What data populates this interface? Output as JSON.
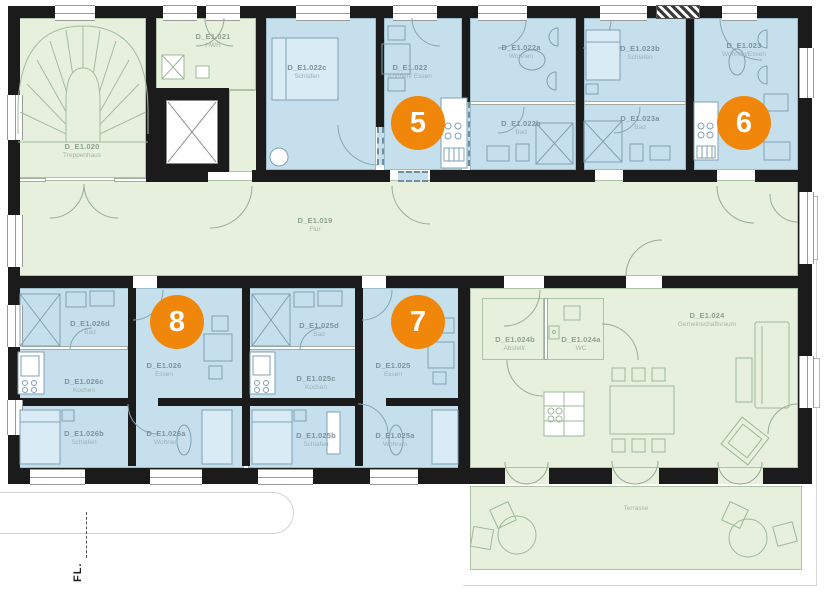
{
  "palette": {
    "room_blue": "#c5e0ec",
    "room_green": "#e6f0dc",
    "wall_black": "#1b1b1b",
    "badge_orange": "#f0870b"
  },
  "rooms": {
    "r019": {
      "id": "D_E1.019",
      "name": "Flur"
    },
    "r020": {
      "id": "D_E1.020",
      "name": "Treppenhaus"
    },
    "r021": {
      "id": "D_E1.021",
      "name": "HWR"
    },
    "r022": {
      "id": "D_E1.022",
      "name": "Kochen/ Essen"
    },
    "r022a": {
      "id": "D_E1.022a",
      "name": "Wohnen"
    },
    "r022b": {
      "id": "D_E1.022b",
      "name": "Bad"
    },
    "r022c": {
      "id": "D_E1.022c",
      "name": "Schlafen"
    },
    "r023": {
      "id": "D_E1.023",
      "name": "Wohnen/Essen"
    },
    "r023a": {
      "id": "D_E1.023a",
      "name": "Bad"
    },
    "r023b": {
      "id": "D_E1.023b",
      "name": "Schlafen"
    },
    "r024": {
      "id": "D_E1.024",
      "name": "Gemeinschaftsraum"
    },
    "r024a": {
      "id": "D_E1.024a",
      "name": "WC"
    },
    "r024b": {
      "id": "D_E1.024b",
      "name": "Abstellr."
    },
    "r025": {
      "id": "D_E1.025",
      "name": "Essen"
    },
    "r025a": {
      "id": "D_E1.025a",
      "name": "Wohnen"
    },
    "r025b": {
      "id": "D_E1.025b",
      "name": "Schlafen"
    },
    "r025c": {
      "id": "D_E1.025c",
      "name": "Kochen"
    },
    "r025d": {
      "id": "D_E1.025d",
      "name": "Bad"
    },
    "r026": {
      "id": "D_E1.026",
      "name": "Essen"
    },
    "r026a": {
      "id": "D_E1.026a",
      "name": "Wohnen"
    },
    "r026b": {
      "id": "D_E1.026b",
      "name": "Schlafen"
    },
    "r026c": {
      "id": "D_E1.026c",
      "name": "Kochen"
    },
    "r026d": {
      "id": "D_E1.026d",
      "name": "Bad"
    },
    "terrace": {
      "name": "Terrasse"
    }
  },
  "badges": {
    "b5": "5",
    "b6": "6",
    "b7": "7",
    "b8": "8"
  },
  "annotations": {
    "fl": "FL."
  }
}
